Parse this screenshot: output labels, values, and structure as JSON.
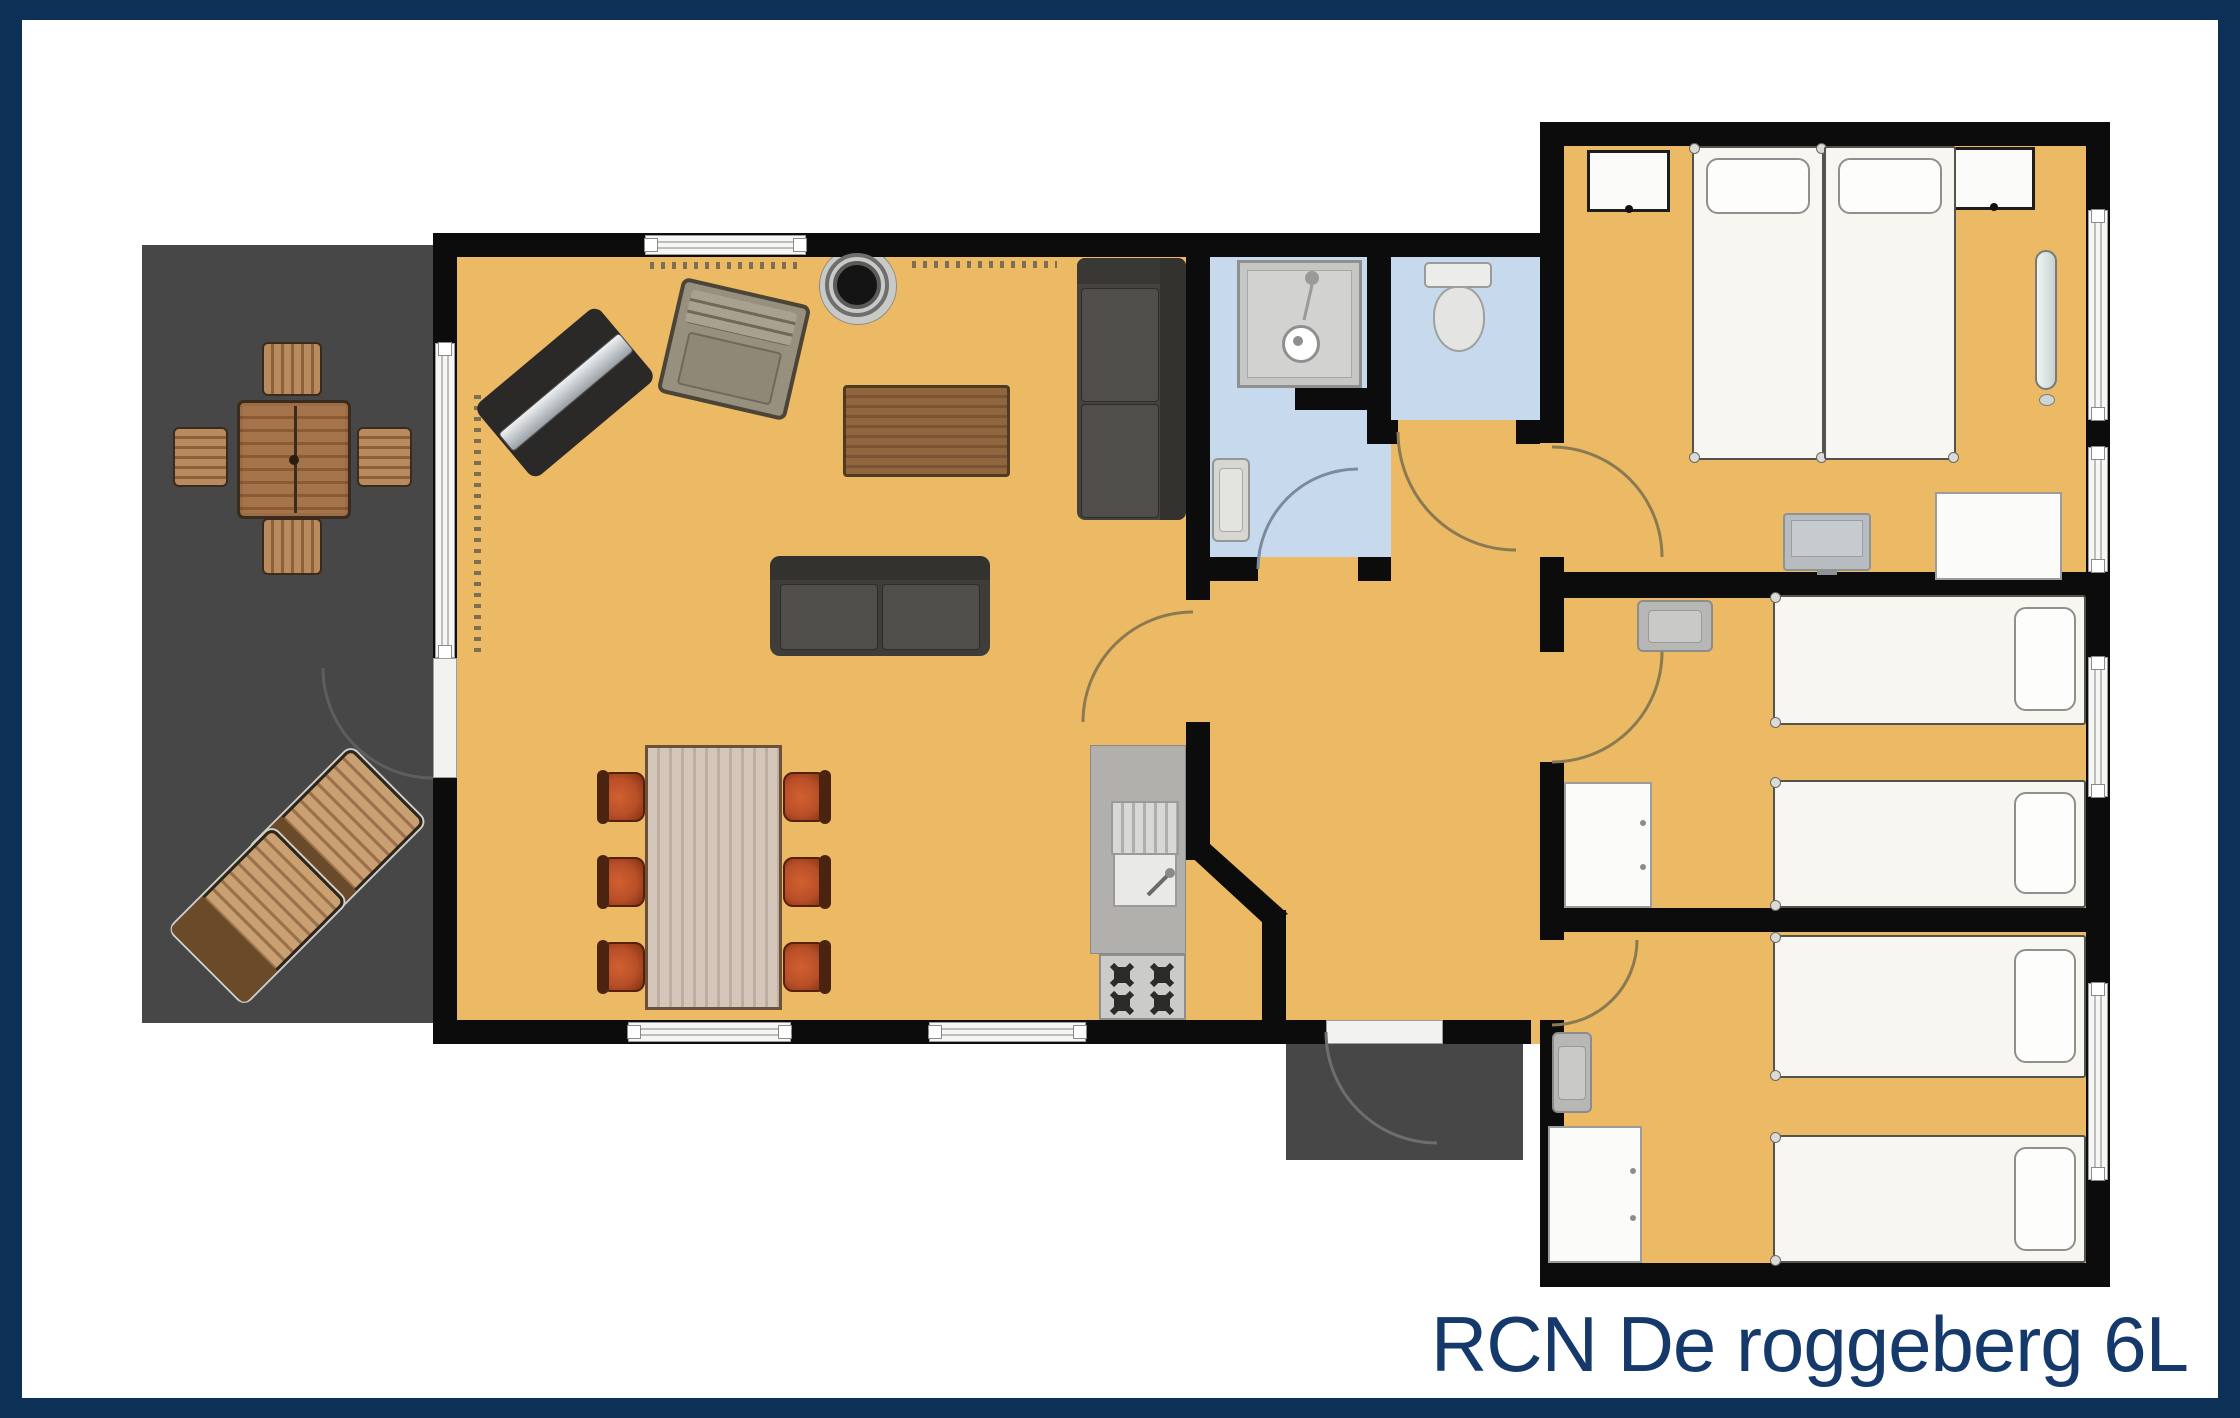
{
  "title": {
    "text": "RCN De roggeberg 6L",
    "color": "#14396a"
  },
  "palette": {
    "frame_navy": "#0d3056",
    "caption_navy": "#14396a",
    "wall_black": "#0c0c0c",
    "floor_tan": "#ecb964",
    "bathroom_blue": "#c7daed",
    "terrace_gray": "#474747",
    "kitchen_gray": "#b1b0ad",
    "chair_red": "#b94f28",
    "mattress_white": "#f8f6f1"
  }
}
